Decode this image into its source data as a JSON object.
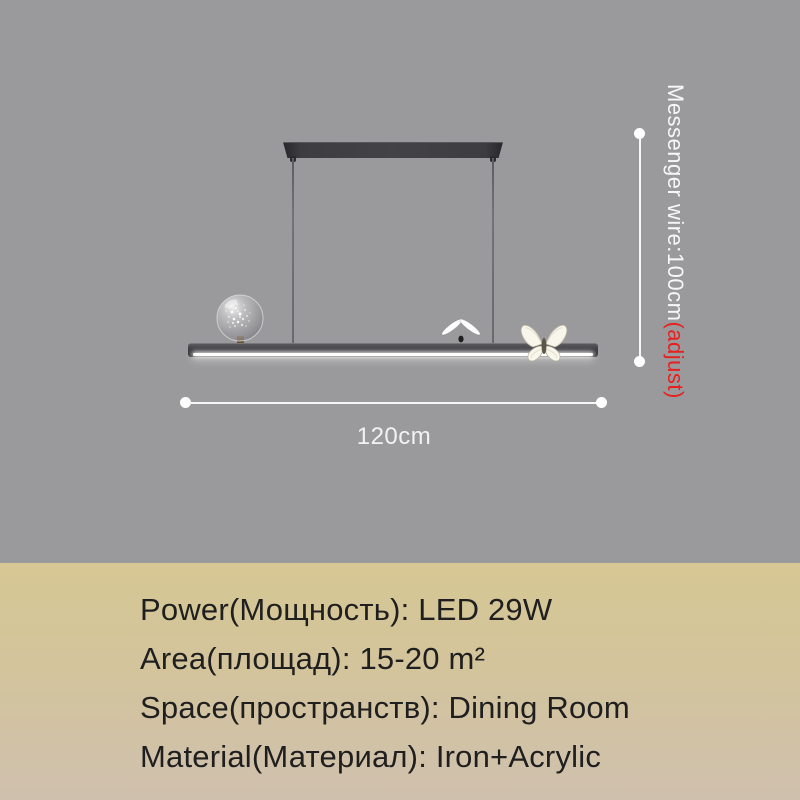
{
  "scene": {
    "wire_label": "Messenger wire:100cm",
    "wire_label_adjust": "(adjust)",
    "width_label": "120cm",
    "icons": [
      "starry-globe-ornament",
      "butterfly-wings-up-icon",
      "butterfly-spread-icon"
    ]
  },
  "specs": {
    "lines": [
      "Power(Мощность): LED 29W",
      "Area(площад): 15-20 m²",
      "Space(пространств): Dining Room",
      "Material(Материал): Iron+Acrylic"
    ]
  },
  "colors": {
    "scene_background": "#9a9a9c",
    "panel_top": "#d6c794",
    "panel_bottom": "#cfc0ae",
    "lamp_dark": "#3a3a3e",
    "dimension_white": "#f7f7f7",
    "accent_red": "#e81f1f",
    "spec_text": "#1f1f1f"
  }
}
